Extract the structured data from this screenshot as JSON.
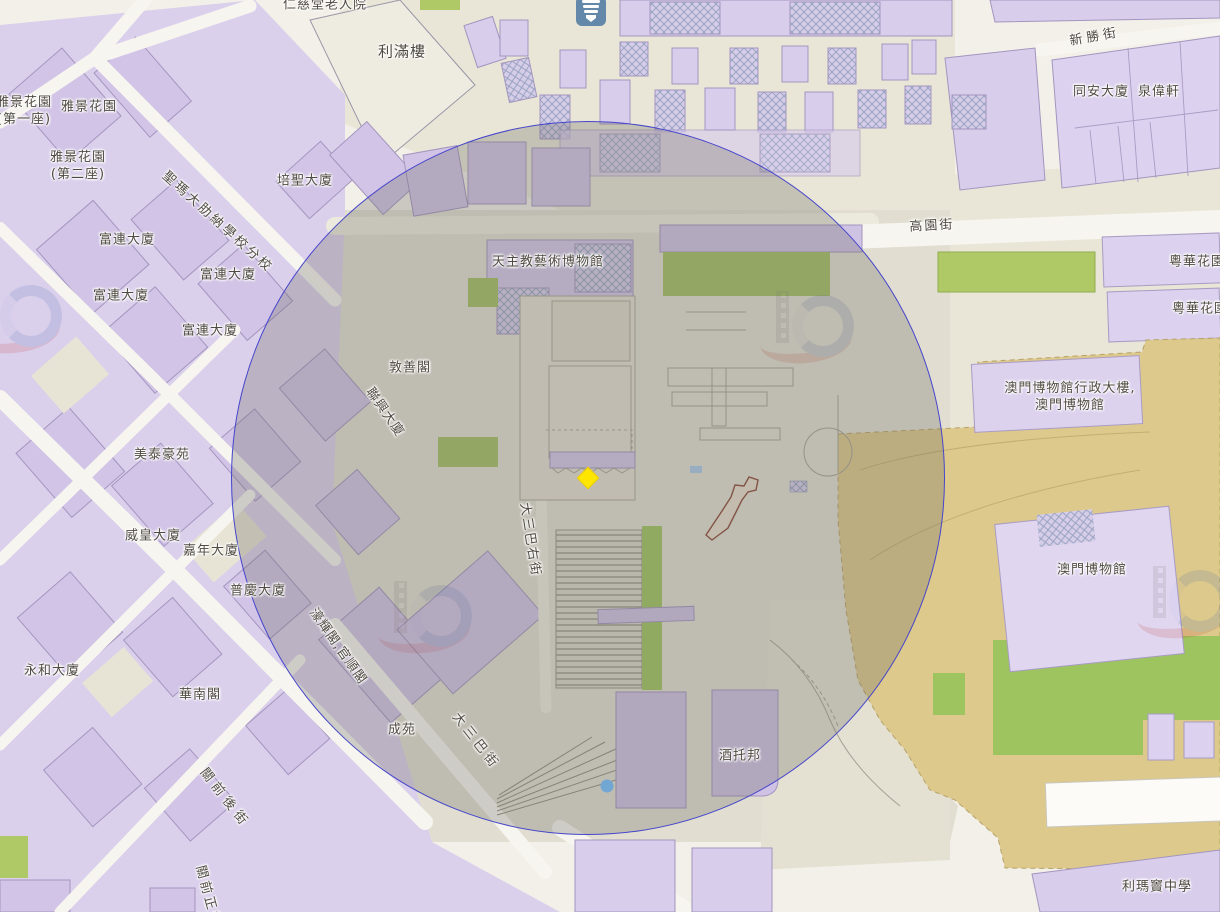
{
  "map": {
    "description": "Street map of central Macau around the Ruins of St. Paul's and Monte Fort, with a circular radius overlay and a selected-location marker",
    "labels": [
      {
        "text": "仁慈堂老人院",
        "x": 325,
        "y": 6
      },
      {
        "text": "利滿樓",
        "x": 402,
        "y": 52,
        "fs": 15
      },
      {
        "text": "新勝街",
        "x": 1095,
        "y": 38,
        "r": -10,
        "ls": 4
      },
      {
        "text": "雅景花園\n(第一座)",
        "x": 24,
        "y": 112
      },
      {
        "text": "雅景花園",
        "x": 89,
        "y": 108
      },
      {
        "text": "雅景花園\n(第二座)",
        "x": 78,
        "y": 167
      },
      {
        "text": "同安大廈",
        "x": 1101,
        "y": 93
      },
      {
        "text": "泉偉軒",
        "x": 1159,
        "y": 93
      },
      {
        "text": "培聖大廈",
        "x": 305,
        "y": 182
      },
      {
        "text": "聖瑪大肋納學校分校",
        "x": 217,
        "y": 223,
        "r": 42,
        "ls": 3
      },
      {
        "text": "高園街",
        "x": 932,
        "y": 227,
        "r": -3,
        "ls": 2
      },
      {
        "text": "富連大廈",
        "x": 127,
        "y": 241
      },
      {
        "text": "天主教藝術博物館",
        "x": 548,
        "y": 263
      },
      {
        "text": "粵華花園",
        "x": 1197,
        "y": 263
      },
      {
        "text": "富連大廈",
        "x": 228,
        "y": 276
      },
      {
        "text": "富連大廈",
        "x": 121,
        "y": 297
      },
      {
        "text": "粵華花園",
        "x": 1200,
        "y": 310
      },
      {
        "text": "富連大廈",
        "x": 210,
        "y": 332
      },
      {
        "text": "敦善閣",
        "x": 410,
        "y": 369
      },
      {
        "text": "澳門博物館行政大樓,\n澳門博物館",
        "x": 1070,
        "y": 398
      },
      {
        "text": "聯興大廈",
        "x": 384,
        "y": 413,
        "r": 55
      },
      {
        "text": "美泰豪苑",
        "x": 162,
        "y": 456
      },
      {
        "text": "威皇大廈",
        "x": 153,
        "y": 537
      },
      {
        "text": "大三巴右街",
        "x": 529,
        "y": 540,
        "r": 81,
        "ls": 2
      },
      {
        "text": "嘉年大廈",
        "x": 211,
        "y": 552
      },
      {
        "text": "澳門博物館",
        "x": 1092,
        "y": 571
      },
      {
        "text": "普慶大廈",
        "x": 258,
        "y": 592
      },
      {
        "text": "濠輝閣,官順閣",
        "x": 337,
        "y": 647,
        "r": 55
      },
      {
        "text": "永和大廈",
        "x": 52,
        "y": 672
      },
      {
        "text": "華南閣",
        "x": 200,
        "y": 696
      },
      {
        "text": "成苑",
        "x": 402,
        "y": 731
      },
      {
        "text": "大三巴街",
        "x": 475,
        "y": 742,
        "r": 52,
        "ls": 4
      },
      {
        "text": "酒托邦",
        "x": 740,
        "y": 757
      },
      {
        "text": "關前後街",
        "x": 224,
        "y": 799,
        "r": 52,
        "ls": 5
      },
      {
        "text": "利瑪竇中學",
        "x": 1157,
        "y": 888
      },
      {
        "text": "關前正街",
        "x": 207,
        "y": 897,
        "r": 75,
        "ls": 3
      }
    ],
    "overlay_circle": {
      "cx": 588,
      "cy": 478,
      "r": 357,
      "fill": "#6f6d66",
      "fill_opacity": 0.3,
      "stroke": "#4545cc"
    },
    "markers": {
      "selected_location": {
        "shape": "diamond",
        "x": 588,
        "y": 478,
        "color": "#ffe600"
      },
      "point_of_interest_dot": {
        "shape": "circle",
        "x": 607,
        "y": 786,
        "color": "#72a7d3"
      }
    },
    "poi_icon": {
      "name": "temple-poi-icon",
      "x": 591,
      "y": 10,
      "bg": "#5b81a7"
    },
    "watermarks": [
      {
        "x": 18,
        "y": 315
      },
      {
        "x": 810,
        "y": 325
      },
      {
        "x": 428,
        "y": 615
      },
      {
        "x": 1187,
        "y": 600
      }
    ],
    "colors": {
      "street": "#f3f0e9",
      "block_purple": "#d9cdec",
      "building_purple": "#d2c4e6",
      "building_outline": "#a395bf",
      "land_beige": "#e9e6d7",
      "plaza": "#e1ded1",
      "park_green": "#aec965",
      "fort_tan": "#ddc98c",
      "overlay_stroke": "#4545cc",
      "marker_yellow": "#ffe600",
      "dot_blue": "#72a7d3"
    }
  }
}
